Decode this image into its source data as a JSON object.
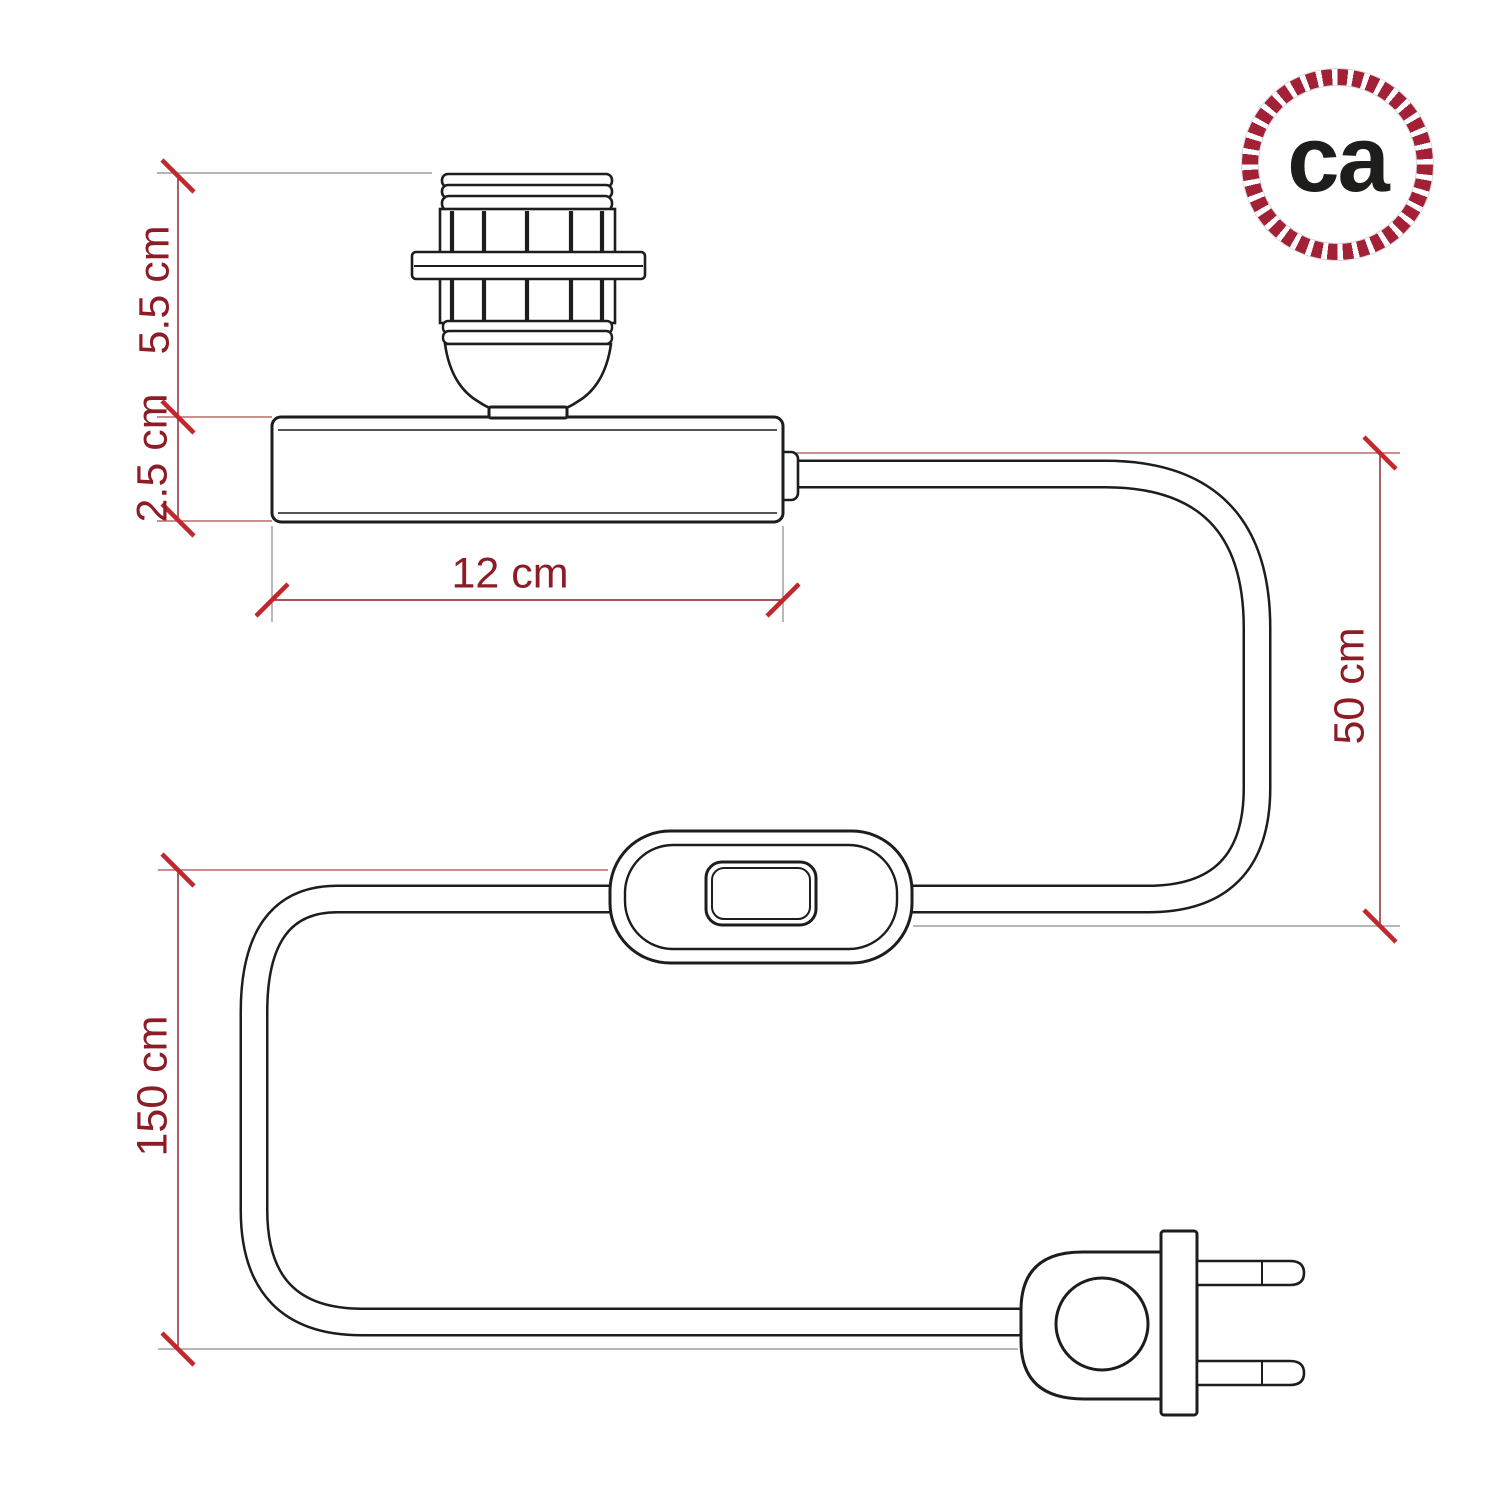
{
  "logo": {
    "text": "ca",
    "icon": "rope-circle-logo"
  },
  "dimensions": {
    "socket_height": "5.5 cm",
    "base_height": "2.5 cm",
    "base_width": "12 cm",
    "cable_riser": "50 cm",
    "cable_total": "150 cm"
  },
  "colors": {
    "background": "#ffffff",
    "drawing_line": "#1d1d1d",
    "dimension_text": "#8c1c26",
    "dimension_line": "#8c1c26",
    "tick": "#c2272e",
    "ext_red": "#b24a4a",
    "ext_gray": "#8a8a8a",
    "logo_ring": "#a32137",
    "logo_text": "#1d1d1b"
  }
}
